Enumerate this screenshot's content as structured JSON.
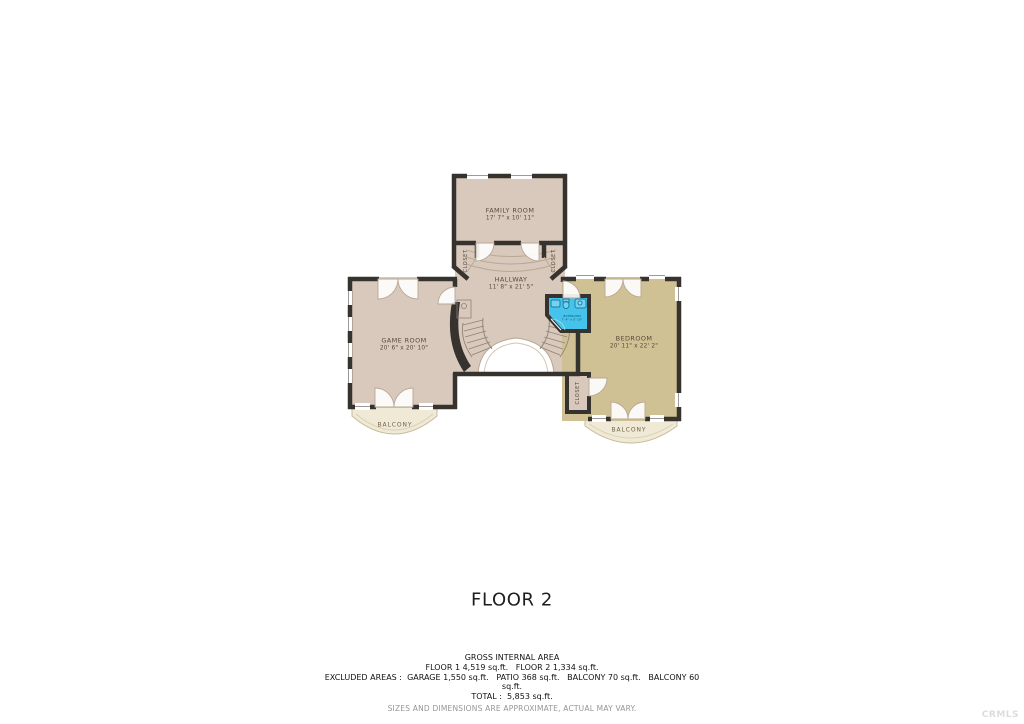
{
  "floorplan": {
    "title": "FLOOR 2",
    "rooms": {
      "family": {
        "name": "FAMILY ROOM",
        "dims": "17' 7\" x 10' 11\""
      },
      "hallway": {
        "name": "HALLWAY",
        "dims": "11' 8\" x 21' 5\""
      },
      "game": {
        "name": "GAME ROOM",
        "dims": "20' 6\" x 20' 10\""
      },
      "bedroom": {
        "name": "BEDROOM",
        "dims": "20' 11\" x 22' 2\""
      },
      "bathroom": {
        "name": "BATHROOM",
        "dims": "7' 4\" x 5' 10\""
      }
    },
    "labels": {
      "closet": "CLOSET",
      "balcony": "BALCONY"
    },
    "colors": {
      "wall": "#36322e",
      "floor_main": "#d8c9bc",
      "floor_bedroom": "#cfc194",
      "bathroom": "#45c3ea",
      "balcony": "#f0e9d5",
      "door_arc": "#b9a893"
    }
  },
  "footer": {
    "gross_title": "GROSS INTERNAL AREA",
    "floors_line": "FLOOR 1 4,519 sq.ft.   FLOOR 2 1,334 sq.ft.",
    "excluded_line": "EXCLUDED AREAS :  GARAGE 1,550 sq.ft.   PATIO 368 sq.ft.   BALCONY 70 sq.ft.   BALCONY 60",
    "excluded_line2": "sq.ft.",
    "total_line": "TOTAL :  5,853 sq.ft.",
    "disclaimer": "SIZES AND DIMENSIONS ARE APPROXIMATE, ACTUAL MAY VARY."
  },
  "watermark": "CRMLS"
}
